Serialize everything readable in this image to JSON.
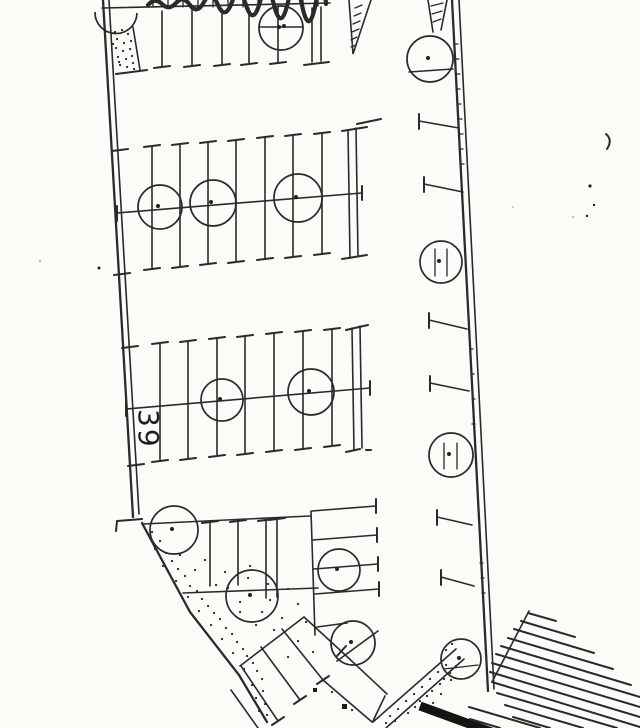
{
  "plan": {
    "stall_count_label": "39",
    "colors": {
      "ink": "#2a2a2a",
      "paper": "#fbfbf8",
      "dark_area": "#141414"
    },
    "trees": [
      {
        "cx": 281,
        "cy": 28,
        "r": 22
      },
      {
        "cx": 430,
        "cy": 59,
        "r": 23
      },
      {
        "cx": 160,
        "cy": 207,
        "r": 22
      },
      {
        "cx": 213,
        "cy": 203,
        "r": 23
      },
      {
        "cx": 298,
        "cy": 198,
        "r": 24
      },
      {
        "cx": 222,
        "cy": 400,
        "r": 21
      },
      {
        "cx": 311,
        "cy": 392,
        "r": 23
      },
      {
        "cx": 441,
        "cy": 262,
        "r": 21
      },
      {
        "cx": 451,
        "cy": 455,
        "r": 22
      },
      {
        "cx": 174,
        "cy": 530,
        "r": 24
      },
      {
        "cx": 252,
        "cy": 596,
        "r": 26
      },
      {
        "cx": 339,
        "cy": 570,
        "r": 21
      },
      {
        "cx": 353,
        "cy": 643,
        "r": 22
      },
      {
        "cx": 461,
        "cy": 659,
        "r": 20
      }
    ],
    "tree_count": 15,
    "parking_row_count": 4
  }
}
